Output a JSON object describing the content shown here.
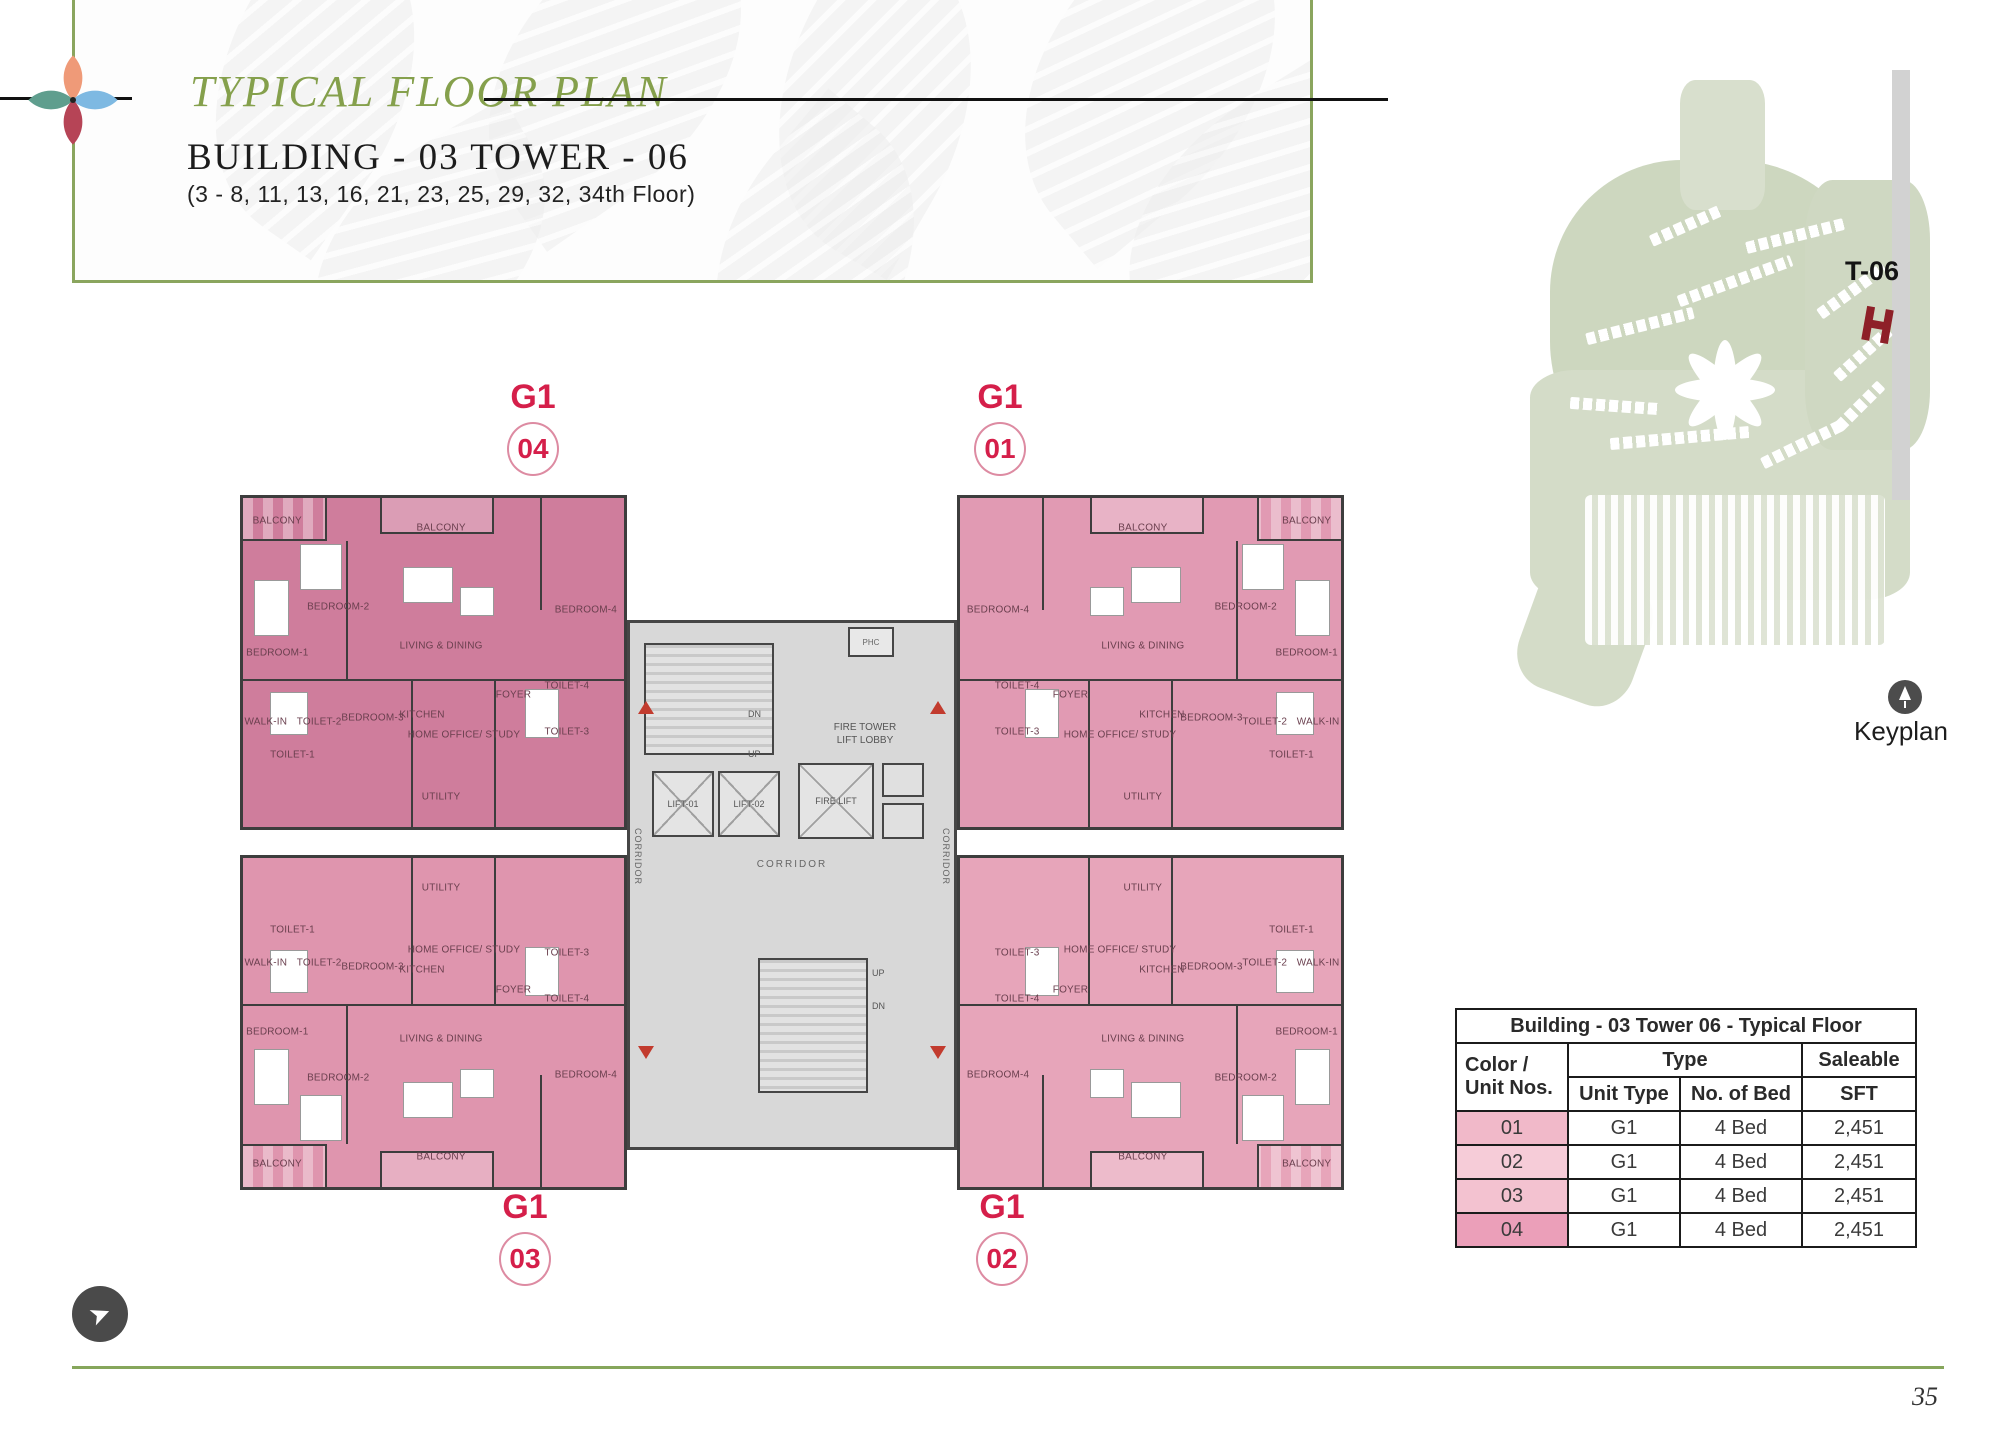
{
  "header": {
    "title": "TYPICAL FLOOR PLAN",
    "building_line": "BUILDING - 03  TOWER - 06",
    "floors_line": "(3 - 8, 11, 13, 16, 21, 23, 25, 29, 32, 34th Floor)"
  },
  "logo_colors": {
    "top": "#ef9a78",
    "left": "#5f9e8e",
    "right": "#7eb9e2",
    "bottom": "#b64456"
  },
  "plan": {
    "units": [
      {
        "no": "04",
        "type": "G1",
        "fill": "#cf7d9c",
        "flip_x": false,
        "flip_y": false
      },
      {
        "no": "01",
        "type": "G1",
        "fill": "#e19ab3",
        "flip_x": true,
        "flip_y": false
      },
      {
        "no": "03",
        "type": "G1",
        "fill": "#df95ae",
        "flip_x": false,
        "flip_y": true
      },
      {
        "no": "02",
        "type": "G1",
        "fill": "#e7a5ba",
        "flip_x": true,
        "flip_y": true
      }
    ],
    "rooms": [
      {
        "label": "BALCONY",
        "x": 9,
        "y": 7
      },
      {
        "label": "BEDROOM-2",
        "x": 25,
        "y": 33
      },
      {
        "label": "BALCONY",
        "x": 52,
        "y": 9
      },
      {
        "label": "LIVING & DINING",
        "x": 52,
        "y": 45
      },
      {
        "label": "BEDROOM-4",
        "x": 90,
        "y": 34
      },
      {
        "label": "BEDROOM-1",
        "x": 9,
        "y": 47
      },
      {
        "label": "WALK-IN",
        "x": 6,
        "y": 68
      },
      {
        "label": "TOILET-2",
        "x": 20,
        "y": 68
      },
      {
        "label": "TOILET-1",
        "x": 13,
        "y": 78
      },
      {
        "label": "BEDROOM-3",
        "x": 34,
        "y": 67
      },
      {
        "label": "KITCHEN",
        "x": 47,
        "y": 66
      },
      {
        "label": "HOME OFFICE/ STUDY",
        "x": 58,
        "y": 72
      },
      {
        "label": "FOYER",
        "x": 71,
        "y": 60
      },
      {
        "label": "TOILET-4",
        "x": 85,
        "y": 57
      },
      {
        "label": "TOILET-3",
        "x": 85,
        "y": 71
      },
      {
        "label": "UTILITY",
        "x": 52,
        "y": 91
      }
    ],
    "core": {
      "stair_dn": "DN",
      "stair_up": "UP",
      "fire_tower_line1": "FIRE TOWER",
      "fire_tower_line2": "LIFT LOBBY",
      "lifts": [
        "LIFT-01",
        "LIFT-02",
        "FIRE LIFT"
      ],
      "phc": "PHC",
      "corridor": "CORRIDOR"
    }
  },
  "keyplan": {
    "tower_label": "T-06",
    "caption": "Keyplan"
  },
  "table": {
    "title": "Building - 03   Tower 06 - Typical Floor",
    "col_color_unit_l1": "Color /",
    "col_color_unit_l2": "Unit Nos.",
    "col_type": "Type",
    "col_unit_type": "Unit Type",
    "col_no_of_bed": "No. of Bed",
    "col_saleable": "Saleable",
    "col_sft": "SFT",
    "rows": [
      {
        "unit": "01",
        "swatch": "#f1b9c9",
        "unit_type": "G1",
        "beds": "4 Bed",
        "sft": "2,451"
      },
      {
        "unit": "02",
        "swatch": "#f6ccd8",
        "unit_type": "G1",
        "beds": "4 Bed",
        "sft": "2,451"
      },
      {
        "unit": "03",
        "swatch": "#f3c2d0",
        "unit_type": "G1",
        "beds": "4 Bed",
        "sft": "2,451"
      },
      {
        "unit": "04",
        "swatch": "#eb9fb9",
        "unit_type": "G1",
        "beds": "4 Bed",
        "sft": "2,451"
      }
    ]
  },
  "page_number": "35"
}
